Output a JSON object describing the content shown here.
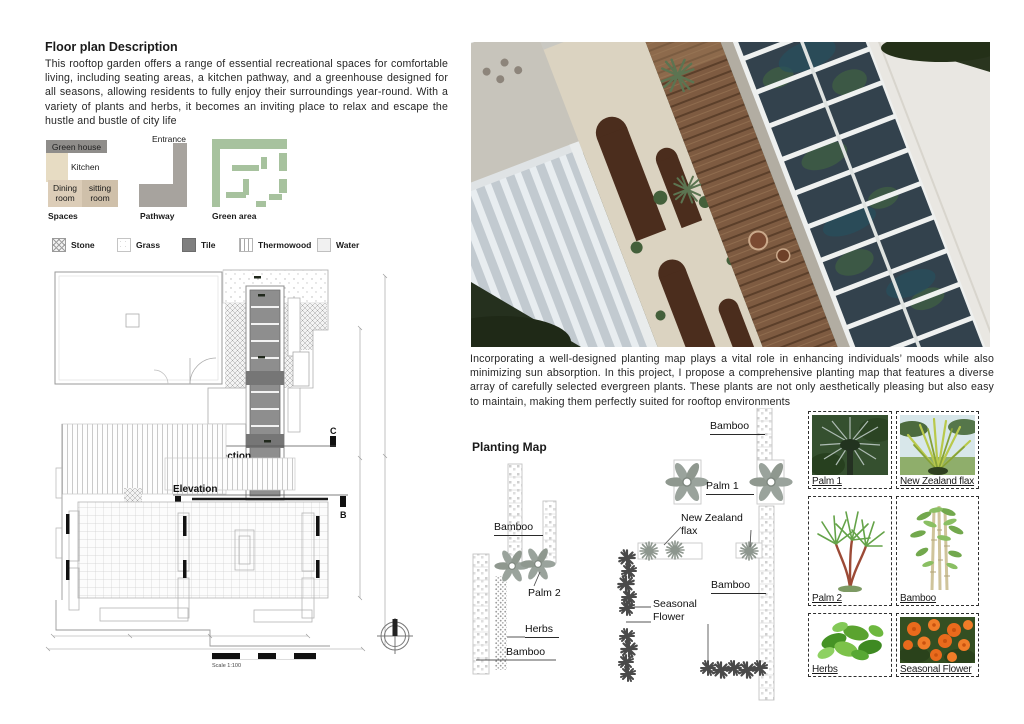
{
  "left": {
    "title": "Floor plan Description",
    "description": "This rooftop garden offers a range of essential recreational spaces for comfortable living, including seating areas, a kitchen pathway, and a greenhouse designed for all seasons, allowing residents to fully enjoy their surroundings year-round. With a variety of plants and herbs, it becomes an inviting place to relax and escape the hustle and bustle of city life",
    "spaces": {
      "caption": "Spaces",
      "green_house": "Green house",
      "kitchen": "Kitchen",
      "dining": "Dining room",
      "sitting": "sitting room"
    },
    "pathway": {
      "entrance": "Entrance",
      "caption": "Pathway"
    },
    "green_area": {
      "caption": "Green area"
    },
    "materials": [
      {
        "name": "Stone"
      },
      {
        "name": "Grass"
      },
      {
        "name": "Tile"
      },
      {
        "name": "Thermowood"
      },
      {
        "name": "Water"
      }
    ],
    "floor_plan": {
      "section_label": "Section",
      "section_marker": "C",
      "elevation_label": "Elevation",
      "elevation_marker": "B",
      "scale_label": "Scale 1:100"
    }
  },
  "right": {
    "paragraph": "Incorporating a well-designed planting map plays a vital role in enhancing individuals’ moods while also minimizing sun absorption. In this project, I propose a comprehensive planting map that features a diverse array of carefully selected evergreen plants. These plants are not only aesthetically pleasing but also easy to maintain, making them perfectly suited for rooftop environments",
    "planting_map": {
      "title": "Planting Map",
      "labels": {
        "left_bamboo": "Bamboo",
        "palm2": "Palm 2",
        "herbs": "Herbs",
        "left_bamboo_bottom": "Bamboo",
        "top_bamboo": "Bamboo",
        "palm1": "Palm 1",
        "nz_flax": "New Zealand flax",
        "right_bamboo": "Bamboo",
        "seasonal_flower": "Seasonal Flower"
      }
    },
    "plant_grid": [
      {
        "label": "Palm 1"
      },
      {
        "label": "New Zealand flax"
      },
      {
        "label": "Palm 2"
      },
      {
        "label": "Bamboo"
      },
      {
        "label": "Herbs"
      },
      {
        "label": "Seasonal Flower"
      }
    ]
  },
  "colors": {
    "green_area": "#a7c29e",
    "tile": "#7f7f7f",
    "pathway": "#a7a39e",
    "kitchen": "#e7dcc3",
    "dining": "#dccdb8",
    "sitting": "#cfc0aa",
    "green_house_legend": "#8f8d8a",
    "greenhouse_glass": "#33424d",
    "deck_wood": "#7e5b41",
    "flower_orange": "#e96a1c"
  }
}
